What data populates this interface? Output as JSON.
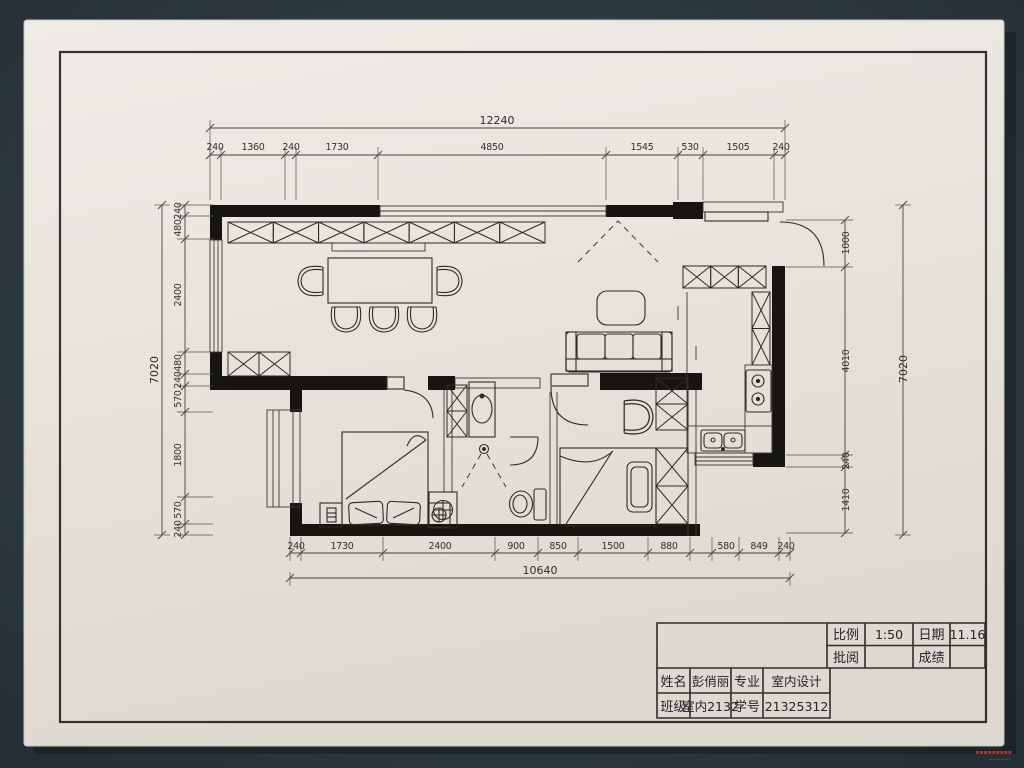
{
  "photo": {
    "background_color": "#31404a",
    "paper_color": "#eae7e1",
    "ink_color": "#2b2925",
    "watermark": {
      "color": "#c0392b",
      "glyphs": "▪▪▪▪▪▪▪▪▪",
      "subline": "·············",
      "subline_color": "#cfc8bf"
    }
  },
  "drawing": {
    "type": "hand-drafted interior floor plan"
  },
  "dimensions": {
    "top": {
      "overall": "12240",
      "segments": [
        "240",
        "1360",
        "240",
        "1730",
        "4850",
        "1545",
        "530",
        "1505",
        "240"
      ]
    },
    "bottom": {
      "overall": "10640",
      "segments": [
        "240",
        "1730",
        "2400",
        "900",
        "850",
        "1500",
        "880",
        "580",
        "849",
        "240"
      ]
    },
    "left": {
      "overall": "7020",
      "segments": [
        "240",
        "480",
        "2400",
        "480",
        "240",
        "570",
        "1800",
        "570",
        "240"
      ]
    },
    "right": {
      "overall": "7020",
      "segments": [
        "1000",
        "4010",
        "240",
        "1410"
      ]
    }
  },
  "title_block": {
    "scale_label": "比例",
    "scale_value": "1:50",
    "date_label": "日期",
    "date_value": "11.16",
    "review_label": "批阅",
    "review_value": "",
    "grade_label": "成绩",
    "grade_value": "",
    "name_label": "姓名",
    "name_value": "彭俏丽",
    "major_label": "专业",
    "major_value": "室内设计",
    "class_label": "班级",
    "class_value": "室内2132",
    "id_label": "学号",
    "id_value": "21325312"
  }
}
